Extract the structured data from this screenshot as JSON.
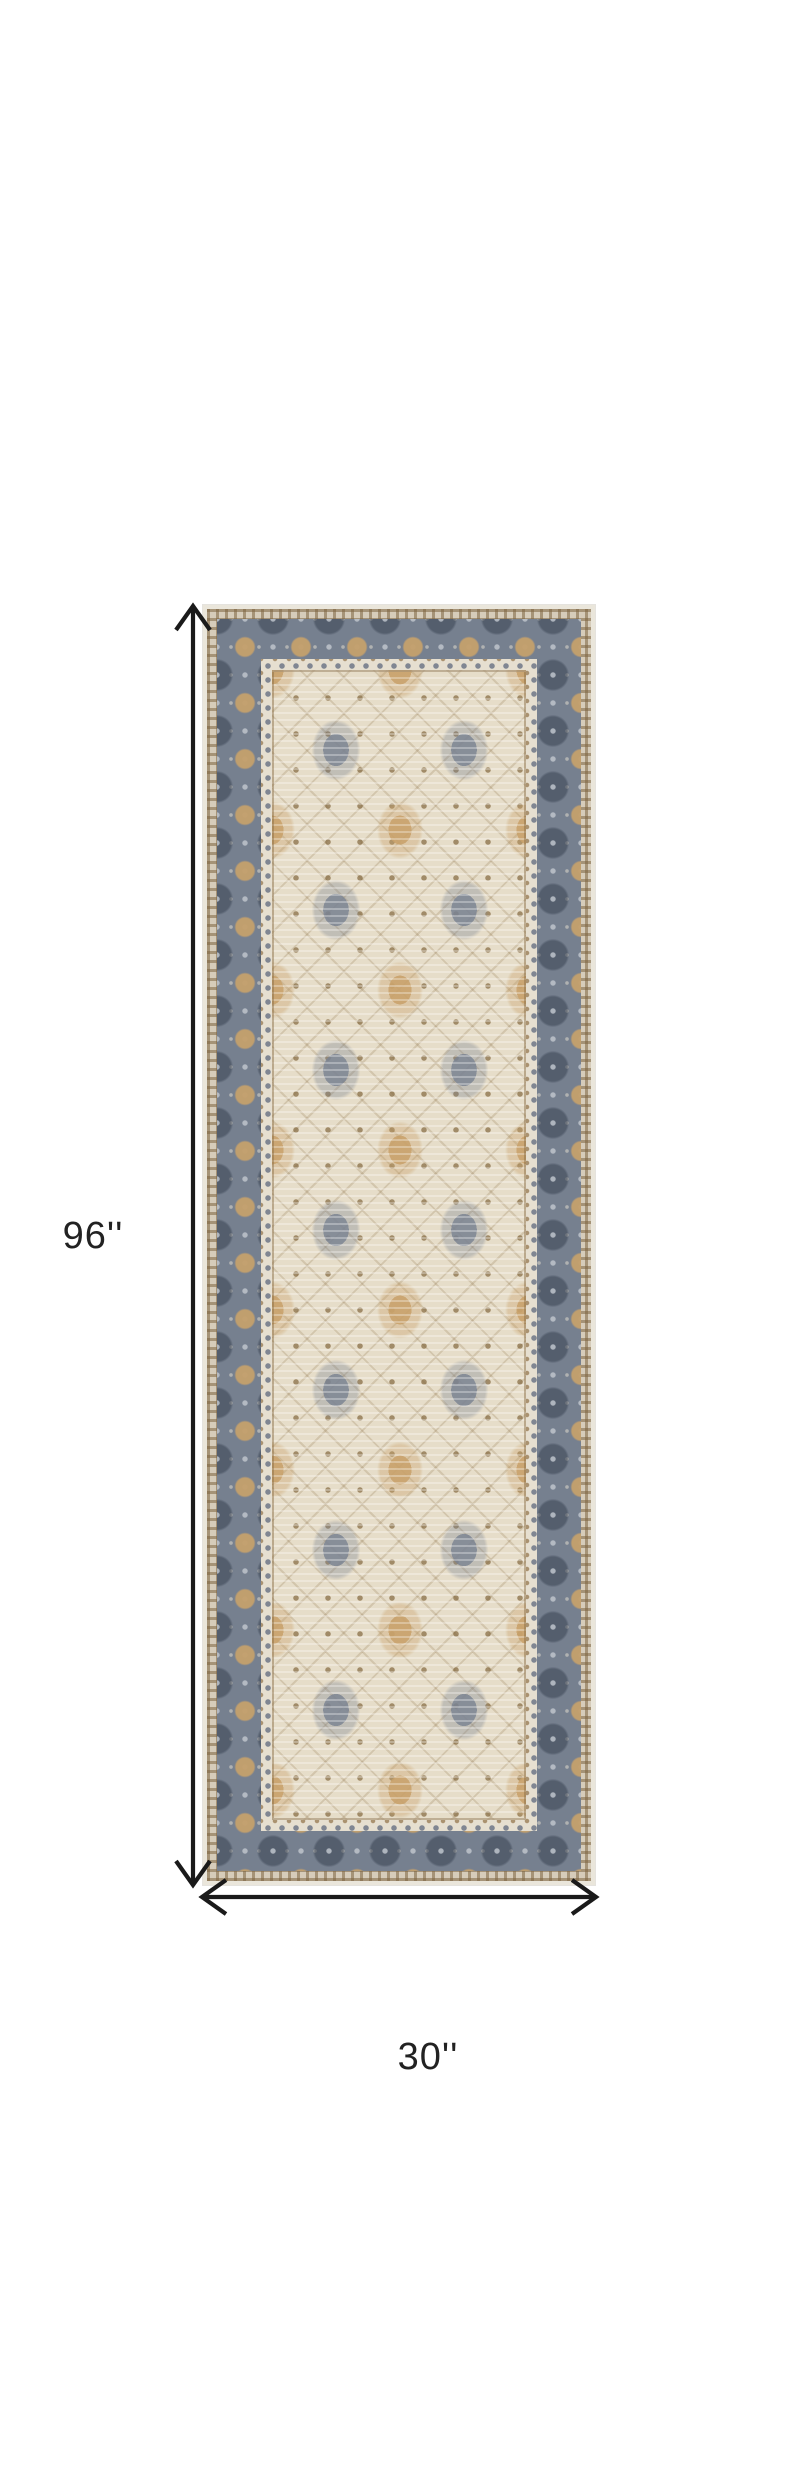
{
  "figure": {
    "type": "product-dimensions",
    "product": "Beige and gray traditional Persian-style runner rug, top view",
    "height_label": "96''",
    "width_label": "30''"
  },
  "colors": {
    "canvas-bg": "#ffffff",
    "arrow": "#1a1a1a",
    "label-text": "#222222",
    "rug-edge": "#eae6db",
    "rug-fine-band": "#d6ccba",
    "rug-border-ground": "#76808f",
    "rug-border-tan": "#c4a06c",
    "rug-border-silver": "#bec4cc",
    "rug-guard": "#e6dfd0",
    "rug-field": "#e6ddc9",
    "rug-motif-gray": "#7a8392",
    "rug-motif-tan": "#c9a26b",
    "rug-motif-brown": "#866b42"
  }
}
